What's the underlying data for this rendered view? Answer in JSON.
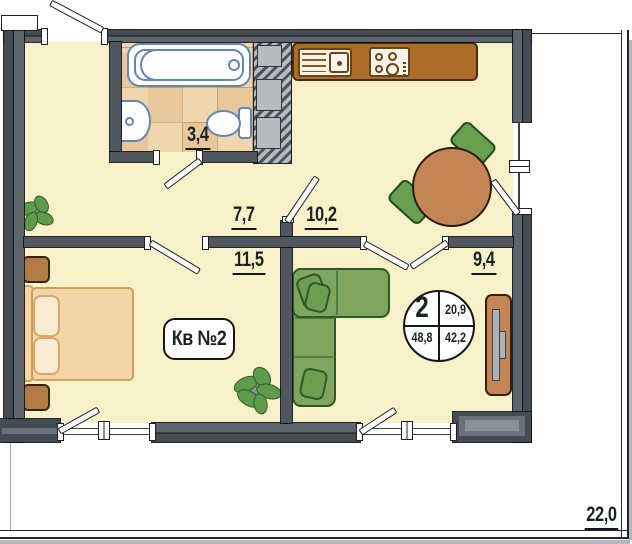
{
  "labels": {
    "apartment": "Кв №2",
    "bathroom_area": "3,4",
    "hallway_area": "7,7",
    "kitchen_area": "10,2",
    "bedroom_area": "11,5",
    "living_area": "9,4",
    "terrace_area": "22,0"
  },
  "badge": {
    "number": "2",
    "top_right": "20,9",
    "bottom_left": "48,8",
    "bottom_right": "42,2"
  },
  "colors": {
    "wall": "#4f565e",
    "wall_dark": "#454b53",
    "wall_light": "#5d646c",
    "ink": "#1d2125",
    "floor": "#f6f1c8",
    "tile": "#efd6ad",
    "tile_dark": "#e2bd8d",
    "counter": "#aa6e29",
    "counter_line": "#4a2c08",
    "unit": "#faf5ea",
    "fixture": "#6584ba",
    "green": "#7fa55e",
    "green_dark": "#2d5b28",
    "cushion": "#6e9e50",
    "chair": "#68a04f",
    "chair_dark": "#1f4d1c",
    "plant": "#5f9b48",
    "plant_dark": "#2f5a26",
    "wood": "#c28553",
    "wood_dark": "#33200e",
    "bed": "#f3d6a8",
    "bed_line": "#cf9f60",
    "pillow": "#f9ead2",
    "nightstand": "#b07c43",
    "gray_box": "#b9bcbe",
    "metal": "#adb2b5"
  }
}
